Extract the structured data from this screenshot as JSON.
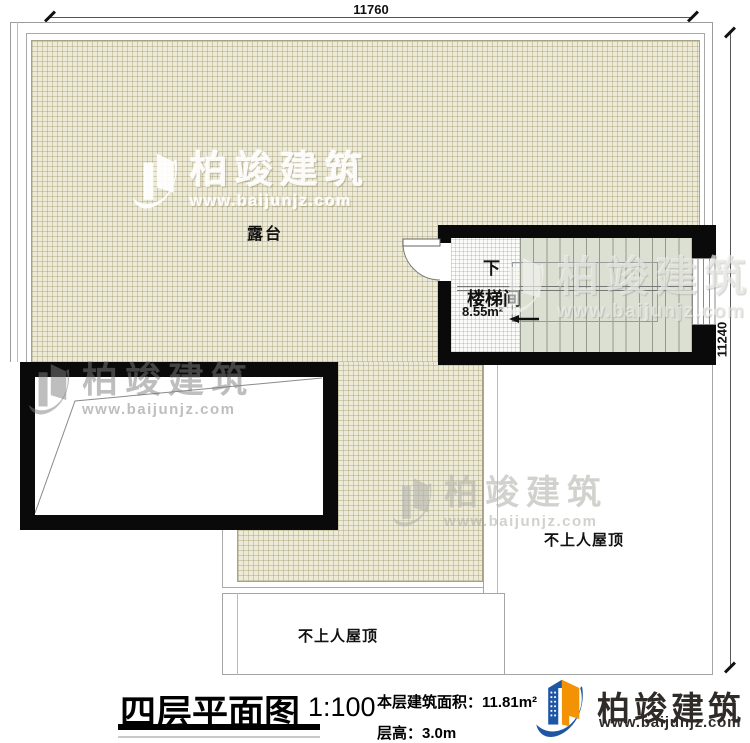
{
  "dimensions": {
    "top": "11760",
    "right": "11240"
  },
  "plan": {
    "terrace_label": "露台",
    "stairwell": {
      "name": "楼梯间",
      "area": "8.55m²",
      "direction": "下"
    },
    "roof_right_label": "不上人屋顶",
    "roof_bottom_label": "不上人屋顶"
  },
  "watermark": {
    "cn": "柏竣建筑",
    "url": "www.baijunjz.com"
  },
  "footer": {
    "title": "四层平面图",
    "scale": "1:100",
    "area_label": "本层建筑面积：",
    "area_value": "11.81m²",
    "height_label": "层高：",
    "height_value": "3.0m",
    "brand": "柏竣建筑",
    "brand_url": "www.baijunjz.com"
  },
  "colors": {
    "wall": "#0a0a0a",
    "hatch_bg": "#edead8",
    "hatch_line": "#b7b190",
    "stair_bg": "#dce0d3",
    "brand_blue": "#1d56a4",
    "brand_orange": "#f39204"
  }
}
